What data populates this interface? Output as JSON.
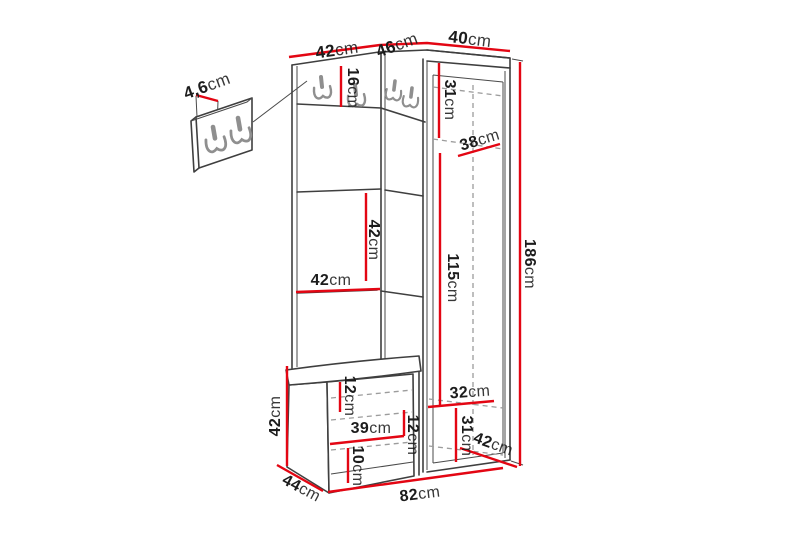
{
  "figure": {
    "unit": "cm",
    "colors": {
      "dimension_line": "#e30613",
      "outline": "#3f3f3f",
      "hidden_lines": "#9c9c9c",
      "text": "#1c1c1c",
      "background": "#ffffff"
    },
    "hooks": {
      "wall_panel_detail": 2,
      "main_unit": 4
    }
  },
  "dims": [
    {
      "value": "42",
      "unit": "cm"
    },
    {
      "value": "46",
      "unit": "cm"
    },
    {
      "value": "40",
      "unit": "cm"
    },
    {
      "value": "4,6",
      "unit": "cm"
    },
    {
      "value": "16",
      "unit": "cm"
    },
    {
      "value": "31",
      "unit": "cm"
    },
    {
      "value": "38",
      "unit": "cm"
    },
    {
      "value": "42",
      "unit": "cm"
    },
    {
      "value": "115",
      "unit": "cm"
    },
    {
      "value": "42",
      "unit": "cm"
    },
    {
      "value": "186",
      "unit": "cm"
    },
    {
      "value": "42",
      "unit": "cm"
    },
    {
      "value": "12",
      "unit": "cm"
    },
    {
      "value": "39",
      "unit": "cm"
    },
    {
      "value": "12",
      "unit": "cm"
    },
    {
      "value": "10",
      "unit": "cm"
    },
    {
      "value": "32",
      "unit": "cm"
    },
    {
      "value": "31",
      "unit": "cm"
    },
    {
      "value": "42",
      "unit": "cm"
    },
    {
      "value": "44",
      "unit": "cm"
    },
    {
      "value": "82",
      "unit": "cm"
    }
  ]
}
